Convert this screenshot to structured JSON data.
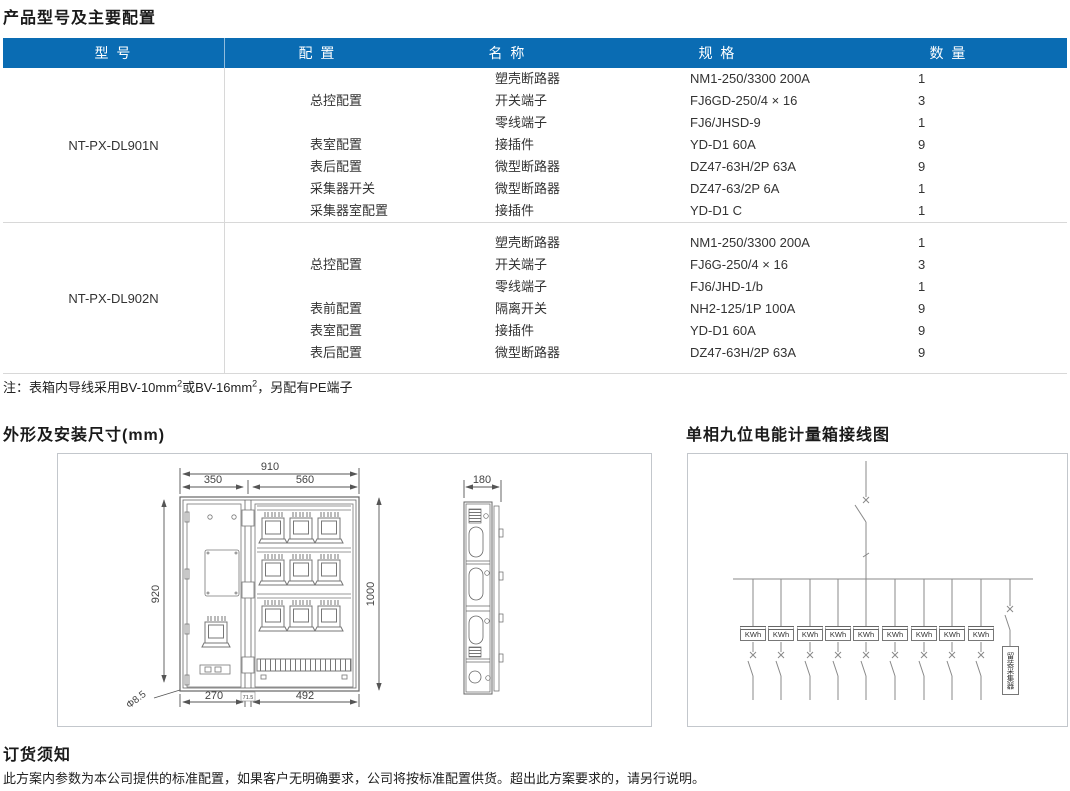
{
  "title": "产品型号及主要配置",
  "table": {
    "headers": {
      "model": "型 号",
      "config": "配 置",
      "name": "名 称",
      "spec": "规 格",
      "qty": "数 量"
    },
    "sections": [
      {
        "model": "NT-PX-DL901N",
        "rows": [
          {
            "config": "",
            "name": "塑壳断路器",
            "spec": "NM1-250/3300 200A",
            "qty": "1"
          },
          {
            "config": "总控配置",
            "name": "开关端子",
            "spec": "FJ6GD-250/4 × 16",
            "qty": "3"
          },
          {
            "config": "",
            "name": "零线端子",
            "spec": "FJ6/JHSD-9",
            "qty": "1"
          },
          {
            "config": "表室配置",
            "name": "接插件",
            "spec": "YD-D1 60A",
            "qty": "9"
          },
          {
            "config": "表后配置",
            "name": "微型断路器",
            "spec": "DZ47-63H/2P 63A",
            "qty": "9"
          },
          {
            "config": "采集器开关",
            "name": "微型断路器",
            "spec": "DZ47-63/2P 6A",
            "qty": "1"
          },
          {
            "config": "采集器室配置",
            "name": "接插件",
            "spec": "YD-D1 C",
            "qty": "1"
          }
        ]
      },
      {
        "model": "NT-PX-DL902N",
        "rows": [
          {
            "config": "",
            "name": "塑壳断路器",
            "spec": "NM1-250/3300 200A",
            "qty": "1"
          },
          {
            "config": "总控配置",
            "name": "开关端子",
            "spec": "FJ6G-250/4 × 16",
            "qty": "3"
          },
          {
            "config": "",
            "name": "零线端子",
            "spec": "FJ6/JHD-1/b",
            "qty": "1"
          },
          {
            "config": "表前配置",
            "name": "隔离开关",
            "spec": "NH2-125/1P 100A",
            "qty": "9"
          },
          {
            "config": "表室配置",
            "name": "接插件",
            "spec": "YD-D1 60A",
            "qty": "9"
          },
          {
            "config": "表后配置",
            "name": "微型断路器",
            "spec": "DZ47-63H/2P 63A",
            "qty": "9"
          }
        ]
      }
    ]
  },
  "note": {
    "p1": "注：表箱内导线采用BV-10mm",
    "sup1": "2",
    "p2": "或BV-16mm",
    "sup2": "2",
    "p3": "，另配有PE端子"
  },
  "dims": {
    "title": "外形及安装尺寸(mm)",
    "w_total": "910",
    "w_left": "350",
    "w_right": "560",
    "h_left": "920",
    "h_right": "1000",
    "b1": "270",
    "b2": "71.5",
    "b3": "492",
    "hole": "Φ8.5",
    "depth": "180"
  },
  "wiring": {
    "title": "单相九位电能计量箱接线图",
    "kwh_label": "KWh",
    "collector_label": "留装采集器"
  },
  "footer": {
    "title": "订货须知",
    "text": "此方案内参数为本公司提供的标准配置，如果客户无明确要求，公司将按标准配置供货。超出此方案要求的，请另行说明。"
  },
  "colors": {
    "header_bg": "#0a6cb3",
    "header_text": "#ffffff",
    "line_gray": "#777777",
    "border_gray": "#d8d8d8"
  }
}
